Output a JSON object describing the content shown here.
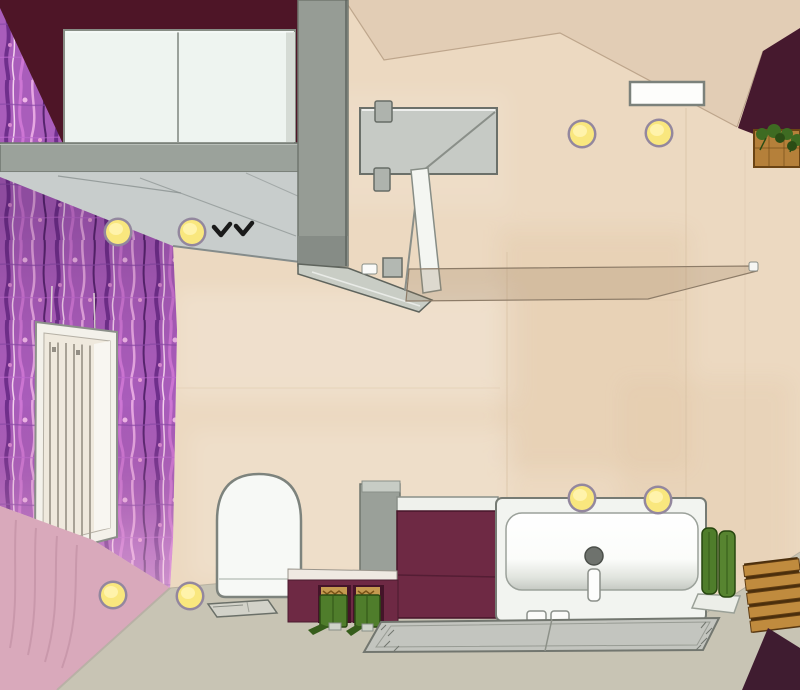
{
  "scene": {
    "kind": "3d-bathroom-planner-top-view",
    "description": "Top-down rendered plan view of a bathroom with aubergine accent walls, purple floral wallpaper, beige tiles and gray screed floor",
    "objects": [
      {
        "id": "accent-wall-top",
        "label": "aubergine accent wall",
        "color": "wall_aubergine"
      },
      {
        "id": "accent-wall-corner",
        "label": "aubergine corner wall",
        "color": "wall_aubergine_corner"
      },
      {
        "id": "wallpaper-wall",
        "label": "purple floral wallpaper wall",
        "color": "wallpaper_purple"
      },
      {
        "id": "wall-lower-pink",
        "label": "pink lower wall section",
        "color": "wallpaper_pink"
      },
      {
        "id": "tile-floor",
        "label": "beige tiled surface",
        "color": "floor_tile_beige"
      },
      {
        "id": "screed-floor",
        "label": "gray screed floor",
        "color": "floor_gray"
      },
      {
        "id": "wall-cabinet",
        "label": "white double-door cabinet",
        "color": "cabinet_white"
      },
      {
        "id": "wall-beam",
        "label": "gray wall beam",
        "color": "beam_gray"
      },
      {
        "id": "partition-column",
        "label": "gray partition column",
        "color": "column_gray"
      },
      {
        "id": "glass-canopy",
        "label": "glass canopy with bird decals",
        "color": "canopy_gray"
      },
      {
        "id": "radiator",
        "label": "white panel radiator",
        "color": "fixture_white"
      },
      {
        "id": "shower-panel",
        "label": "shower head panel",
        "color": "panel_gray"
      },
      {
        "id": "shower-door-edge",
        "label": "shower glass door edge",
        "color": "fixture_white"
      },
      {
        "id": "glass-partition",
        "label": "glass partition screen",
        "color": "glass_tint"
      },
      {
        "id": "toilet",
        "label": "white toilet",
        "color": "fixture_white"
      },
      {
        "id": "floor-tray",
        "label": "gray floor tray",
        "color": "mat_gray"
      },
      {
        "id": "vanity-unit",
        "label": "aubergine vanity unit",
        "color": "vanity_maroon"
      },
      {
        "id": "knee-wall",
        "label": "aubergine knee wall with niches",
        "color": "vanity_maroon"
      },
      {
        "id": "green-stools",
        "label": "green folding stools in niches",
        "color": "towel_green"
      },
      {
        "id": "bathtub",
        "label": "white bathtub with drain and fitting",
        "color": "fixture_white"
      },
      {
        "id": "rolled-towels",
        "label": "rolled green towels on pedestal",
        "color": "towel_green"
      },
      {
        "id": "wooden-stool",
        "label": "wooden slatted stool",
        "color": "wood_brown"
      },
      {
        "id": "bath-mat",
        "label": "gray bath mat",
        "color": "mat_gray"
      },
      {
        "id": "corner-mat",
        "label": "dark corner mat",
        "color": "corner_mat_dark"
      },
      {
        "id": "ceiling-spotlights",
        "label": "recessed ceiling spotlights",
        "color": "light_yellow"
      },
      {
        "id": "wall-vent",
        "label": "white wall vent",
        "color": "fixture_white"
      },
      {
        "id": "plant-crate",
        "label": "plant in wooden crate",
        "color": "plant_green"
      }
    ],
    "counts": {
      "ceiling_spotlights": 8,
      "bird_decals": 2,
      "green_stools": 2,
      "rolled_towels": 2
    }
  },
  "colors": {
    "floor_tile_beige": "#ecd9c1",
    "ceiling_beige": "#e2cdb5",
    "floor_gray": "#c8c4b4",
    "wall_aubergine": "#4e1527",
    "wall_aubergine_corner": "#46192e",
    "corner_mat_dark": "#3f1c30",
    "wallpaper_purple": "#a95dbb",
    "wallpaper_pink": "#d9a9bb",
    "beam_gray": "#9ba29b",
    "column_gray": "#969c95",
    "canopy_gray": "#c6cccc",
    "cabinet_white": "#eef4f0",
    "panel_gray": "#c6cac5",
    "vanity_maroon": "#6e2944",
    "towel_green": "#4f7d2b",
    "towel_green_light": "#578430",
    "wood_brown": "#c08b3e",
    "mat_gray": "#c3c5bf",
    "glass_tint": "rgba(140,114,84,0.22)",
    "light_yellow": "#f9e77e",
    "light_yellow_core": "#fff3ab",
    "light_ring": "#93879e",
    "drain_gray": "#6e726d",
    "plant_green": "#3e6b22",
    "bird_black": "#1a1a1a",
    "fixture_white": "#f7f9f6"
  }
}
